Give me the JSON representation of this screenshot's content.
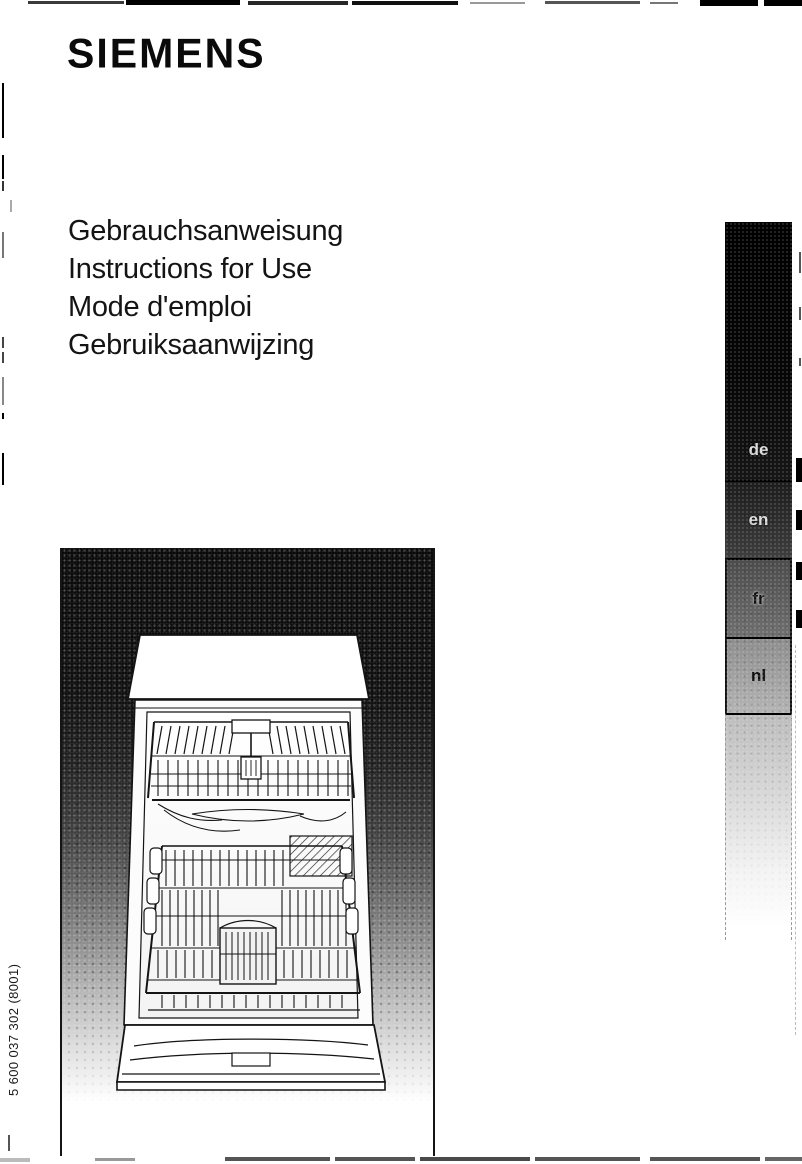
{
  "page": {
    "kind": "instruction manual cover (scanned)",
    "background": "#ffffff",
    "ink": "#0d0d0d"
  },
  "brand": {
    "logo": "SIEMENS"
  },
  "titles": [
    "Gebrauchsanweisung",
    "Instructions for Use",
    "Mode d'emploi",
    "Gebruiksaanwijzing"
  ],
  "language_index": {
    "tabs": [
      {
        "label": "de",
        "tone": "#050505"
      },
      {
        "label": "en",
        "tone": "#2e2e2e"
      },
      {
        "label": "fr",
        "tone": "#5e5e5e"
      },
      {
        "label": "nl",
        "tone": "#a1a1a1"
      }
    ]
  },
  "photo": {
    "subject": "dishwasher-front-open-with-racks"
  },
  "order_number": "5 600 037 302 (8001)"
}
